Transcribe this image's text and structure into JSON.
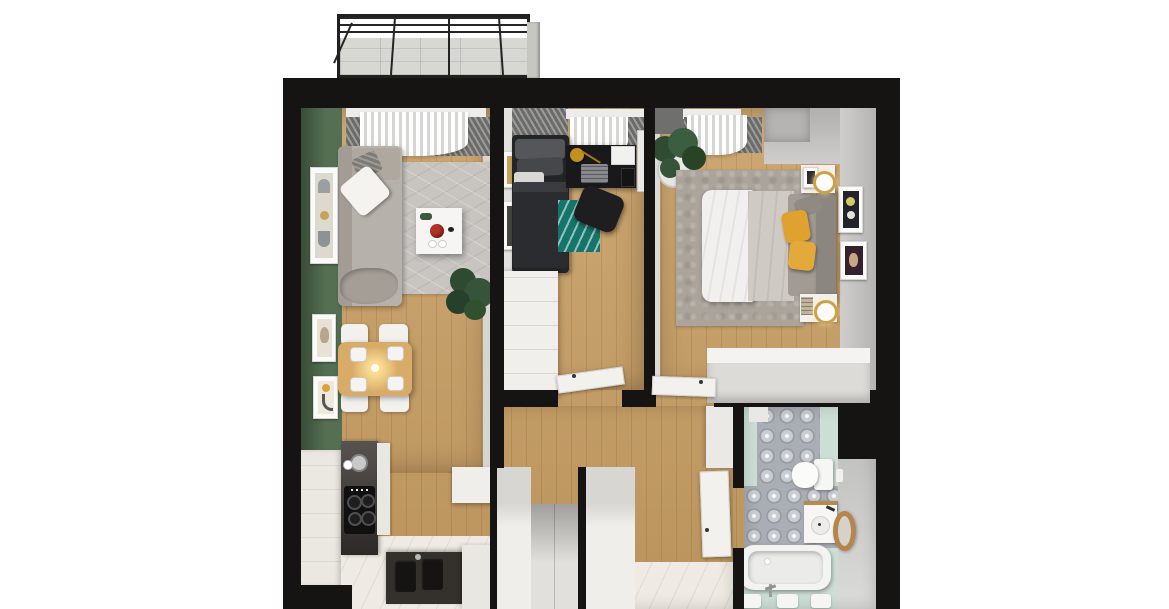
{
  "meta": {
    "scene": "3d-apartment-floor-plan-top-down-render",
    "view": "orthographic top-down cutaway",
    "visible_text": "none"
  },
  "palette": {
    "canvas": "#ffffff",
    "wall": "#161412",
    "wood": "#c89e63",
    "tile": "#efebe4",
    "green_wall": "#4a6648",
    "rug_living": "#c8c5c1",
    "rug_bedroom": "#aba49b",
    "rug_teal": "#15756a",
    "sofa": "#b6b1aa",
    "sofa_back": "#a29c95",
    "pillow_white": "#f4f3f0",
    "pillow_dark": "#7e7a74",
    "coffee_table": "#f6f5f3",
    "red_bowl": "#b23128",
    "dining_table": "#d8ac68",
    "chair": "#f2f1ee",
    "kitchen_cabinet": "#ebe8e2",
    "counter_dark": "#3b3733",
    "cooktop": "#101010",
    "sink_counter": "#34302b",
    "bed_dark": "#242527",
    "desk": "#19191b",
    "lamp_gold": "#c2911d",
    "wardrobe": "#f0efec",
    "wardrobe_front": "#dcdbd8",
    "duvet_white": "#f1f0ee",
    "duvet_gray": "#cfcac3",
    "blanket_gray": "#a19b93",
    "headboard": "#8b867f",
    "pillow_yellow": "#e0a22e",
    "nightstand": "#f2f1ee",
    "mint": "#ccdfd6",
    "bath_tile_base": "#a9aeb4",
    "bath_gray": "#d8d8d5",
    "tub": "#f3f3f1",
    "stool_wood": "#b5854c",
    "balcony_floor": "#d7d7d4",
    "railing": "#242424",
    "plant_green": "#35543a",
    "door": "#f2f1ee",
    "curtain": "#f4f4f2",
    "wall_face_gray": "#c9c8c6",
    "closet": "#e6e4e0"
  },
  "rooms": [
    {
      "name": "balcony",
      "features": [
        "metal-railing",
        "concrete-floor",
        "divider-panel"
      ]
    },
    {
      "name": "living-room",
      "features": [
        "green-accent-wall",
        "three-wall-posters",
        "corner-sofa",
        "white-pillow",
        "gray-rug",
        "white-coffee-table",
        "red-bowl",
        "floor-plant",
        "window-curtain",
        "dining-table",
        "four-chairs",
        "pendant-light",
        "four-place-settings"
      ]
    },
    {
      "name": "kitchen",
      "features": [
        "white-cabinets",
        "dark-counter",
        "coffee-machine",
        "cooktop-4-burners",
        "double-sink",
        "tiled-floor"
      ]
    },
    {
      "name": "small-bedroom",
      "features": [
        "dark-single-bed",
        "black-desk",
        "laptop",
        "gold-desk-lamp",
        "desk-chair",
        "teal-rug",
        "white-wardrobe",
        "two-wall-posters",
        "window-curtain",
        "wall-mirror"
      ]
    },
    {
      "name": "main-bedroom",
      "features": [
        "double-bed",
        "white-duvet",
        "gray-duvet",
        "yellow-pillows",
        "headboard",
        "two-nightstands",
        "two-lamps",
        "two-wall-posters",
        "area-rug",
        "wardrobe",
        "potted-plant",
        "window-curtain"
      ]
    },
    {
      "name": "hallway",
      "features": [
        "entry-closet",
        "partition-walls",
        "open-doors",
        "wood-floor",
        "tiled-entry"
      ]
    },
    {
      "name": "bathroom",
      "features": [
        "patterned-tile-floor",
        "mint-floor",
        "wall-hung-toilet",
        "vanity-sink",
        "round-wood-mirror",
        "bathtub",
        "floor-faucet",
        "bath-mats"
      ]
    }
  ]
}
